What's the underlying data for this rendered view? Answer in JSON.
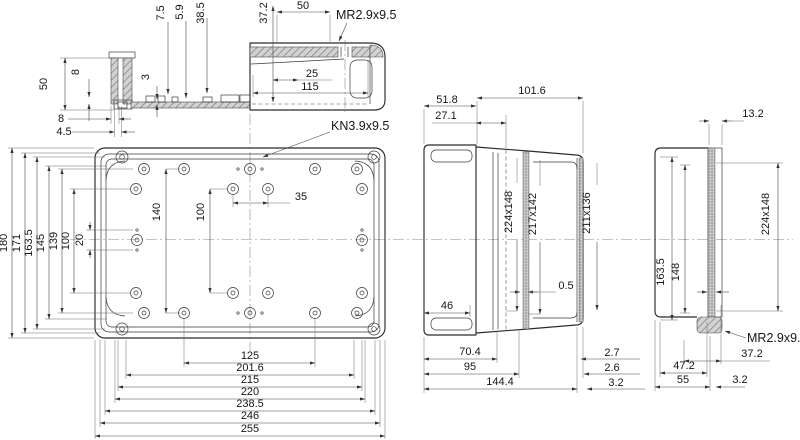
{
  "section": {
    "d50v": "50",
    "d8v": "8",
    "d3": "3",
    "d75": "7.5",
    "d59": "5.9",
    "d385": "38.5",
    "d372": "37.2",
    "d50h": "50",
    "mr": "MR2.9x9.5",
    "d25": "25",
    "d115": "115",
    "d8h": "8",
    "d45": "4.5"
  },
  "plan": {
    "kn": "KN3.9x9.5",
    "left": [
      "180",
      "171",
      "163.5",
      "145",
      "139",
      "100",
      "20"
    ],
    "v140": "140",
    "v100": "100",
    "h35": "35",
    "bottom": [
      "125",
      "201.6",
      "215",
      "220",
      "238.5",
      "246",
      "255"
    ]
  },
  "side": {
    "d1016": "101.6",
    "d518": "51.8",
    "d271": "27.1",
    "s1": "224x148",
    "s2": "217x142",
    "s3": "211x136",
    "d46": "46",
    "d05": "0.5",
    "d704": "70.4",
    "d95": "95",
    "d1444": "144.4",
    "d27": "2.7",
    "d26": "2.6",
    "d32": "3.2"
  },
  "end": {
    "d132": "13.2",
    "s1": "224x148",
    "d1635": "163.5",
    "d148": "148",
    "mr": "MR2.9x9.5",
    "d372": "37.2",
    "d472": "47.2",
    "d55": "55",
    "d32": "3.2"
  }
}
